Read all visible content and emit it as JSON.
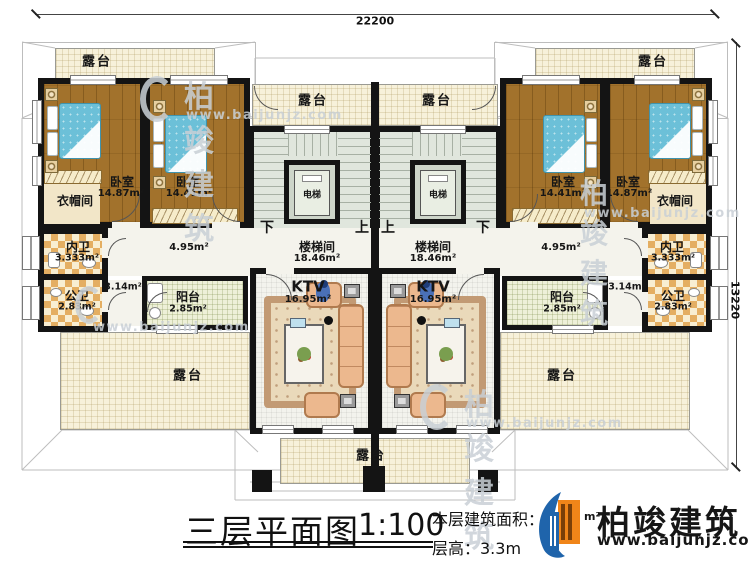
{
  "dimensions": {
    "width_label": "22200",
    "height_label": "13220"
  },
  "title": {
    "name": "三层平面图",
    "scale": "1:100"
  },
  "info": {
    "area_label": "本层建筑面积：",
    "area_visible": "12",
    "area_unit": "m²",
    "height_label": "层高：3.3m"
  },
  "logo": {
    "company": "柏竣建筑",
    "website": "www.baijunjz.com"
  },
  "watermark": {
    "company": "柏竣建筑",
    "website": "www.baijunjz.com"
  },
  "labels": {
    "terrace": "露台",
    "bedroom": "卧室",
    "bedroom_area_large": "14.87m²",
    "bedroom_area_small": "14.41m²",
    "cloakroom": "衣帽间",
    "inner_bath": "内卫",
    "inner_bath_area": "3.333m²",
    "public_bath": "公卫",
    "public_bath_area": "2.83m²",
    "hall_area": "4.95m²",
    "corridor_area": "3.14m²",
    "balcony": "阳台",
    "balcony_area": "2.85m²",
    "stairwell": "楼梯间",
    "stairwell_area": "18.46m²",
    "elevator": "电梯",
    "up": "上",
    "down": "下",
    "ktv": "KTV",
    "ktv_area": "16.95m²"
  }
}
